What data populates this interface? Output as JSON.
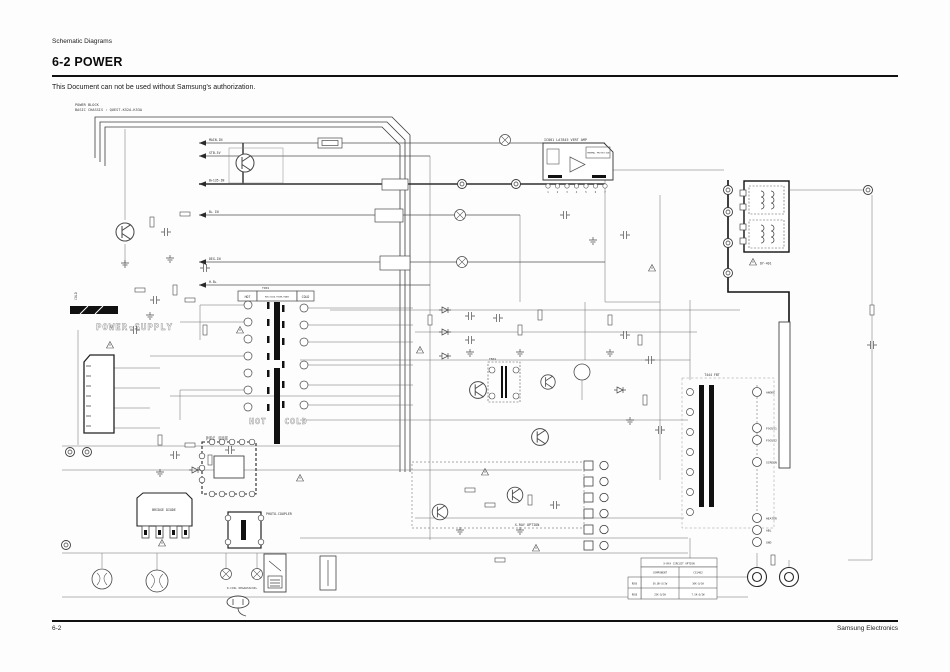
{
  "page": {
    "header_label": "Schematic Diagrams",
    "section_title": "6-2 POWER",
    "notice": "This Document can not be used without Samsung's authorization.",
    "footer_left": "6-2",
    "footer_right": "Samsung Electronics"
  },
  "schematic": {
    "block_title_line1": "POWER BLOCK",
    "block_title_line2": "BASIC CHASSIS : QUEST-K52A-K53A",
    "watermark_power_supply": "POWER-SUPPLY",
    "watermark_hot": "HOT",
    "watermark_cold": "COLD",
    "cold_side_label": "COLD",
    "trans_table": {
      "hot": "HOT",
      "model": "MDB-5021A POWER-TRANS",
      "cold": "COLD"
    },
    "nets": [
      "MAIN-IN",
      "STB-5V",
      "B+135-IN",
      "B+ IN",
      "DEG-IN",
      "H.B+"
    ],
    "ic801": {
      "title": "IC801  LA7845 VERT AMP",
      "thermal": "THERMAL PROTECTION",
      "pins": [
        "1",
        "2",
        "3",
        "4",
        "5",
        "6",
        "7"
      ]
    },
    "blocks": {
      "pfc": "PFC USE",
      "bridge": "BRIDGE DIODE",
      "photo_coupler": "PHOTO-COUPLER",
      "xray_option": "X-RAY OPTION",
      "degauss": "D-COIL DEGAUSSCOIL",
      "dy": "DY-401",
      "trans_ref": "T901",
      "fbt_ref": "T444 FBT",
      "drive_ref": "T801"
    },
    "fbt_pins": [
      "ANODE",
      "FOCUS1",
      "FOCUS2",
      "SCREEN"
    ],
    "crt_pins": [
      "HEATER",
      "ABL",
      "GND"
    ],
    "xray_table": {
      "title": "X-RAY CIRCUIT OPTION",
      "col_component": "COMPONENT",
      "col_option": "CS1402",
      "rows": [
        {
          "ref": "R856",
          "a": "56.8K-Ω/1W",
          "b": "30K-Ω/1W"
        },
        {
          "ref": "R858",
          "a": "22K-Ω/2W",
          "b": "7.5K-Ω/2W"
        }
      ]
    }
  }
}
